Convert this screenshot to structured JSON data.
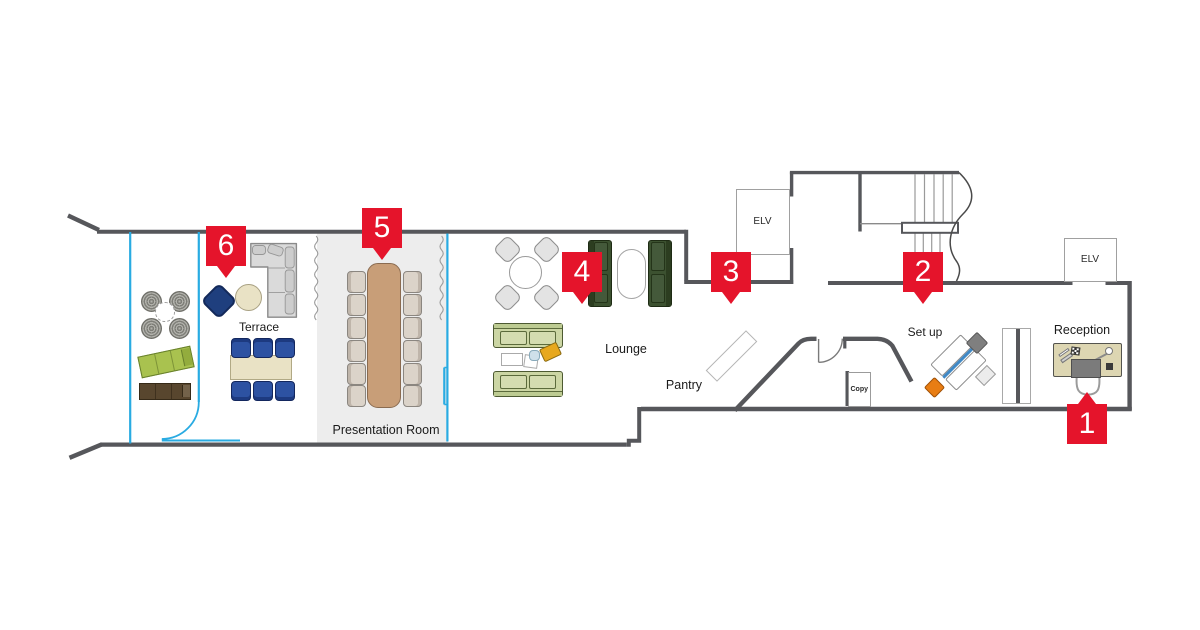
{
  "title": "Office floor plan with numbered locations",
  "colors": {
    "marker_red": "#e5142b",
    "glass_blue": "#29abe2",
    "wall_gray": "#56575b",
    "presentation_room_fill": "#ededed",
    "presentation_table": "#c89e78",
    "dark_green_sofa": "#3c5130",
    "light_green_sofa": "#ccd6a4",
    "navy_chair": "#2d52a2",
    "reception_desk": "#ddd6b2",
    "orange_chair": "#e87d13"
  },
  "markers": [
    {
      "number": "1"
    },
    {
      "number": "2"
    },
    {
      "number": "3"
    },
    {
      "number": "4"
    },
    {
      "number": "5"
    },
    {
      "number": "6"
    }
  ],
  "labels": {
    "terrace": "Terrace",
    "presentation_room": "Presentation Room",
    "lounge": "Lounge",
    "pantry": "Pantry",
    "set_up": "Set up",
    "reception": "Reception",
    "copy": "Copy",
    "elv_stairs": "ELV",
    "elv_lobby": "ELV"
  }
}
